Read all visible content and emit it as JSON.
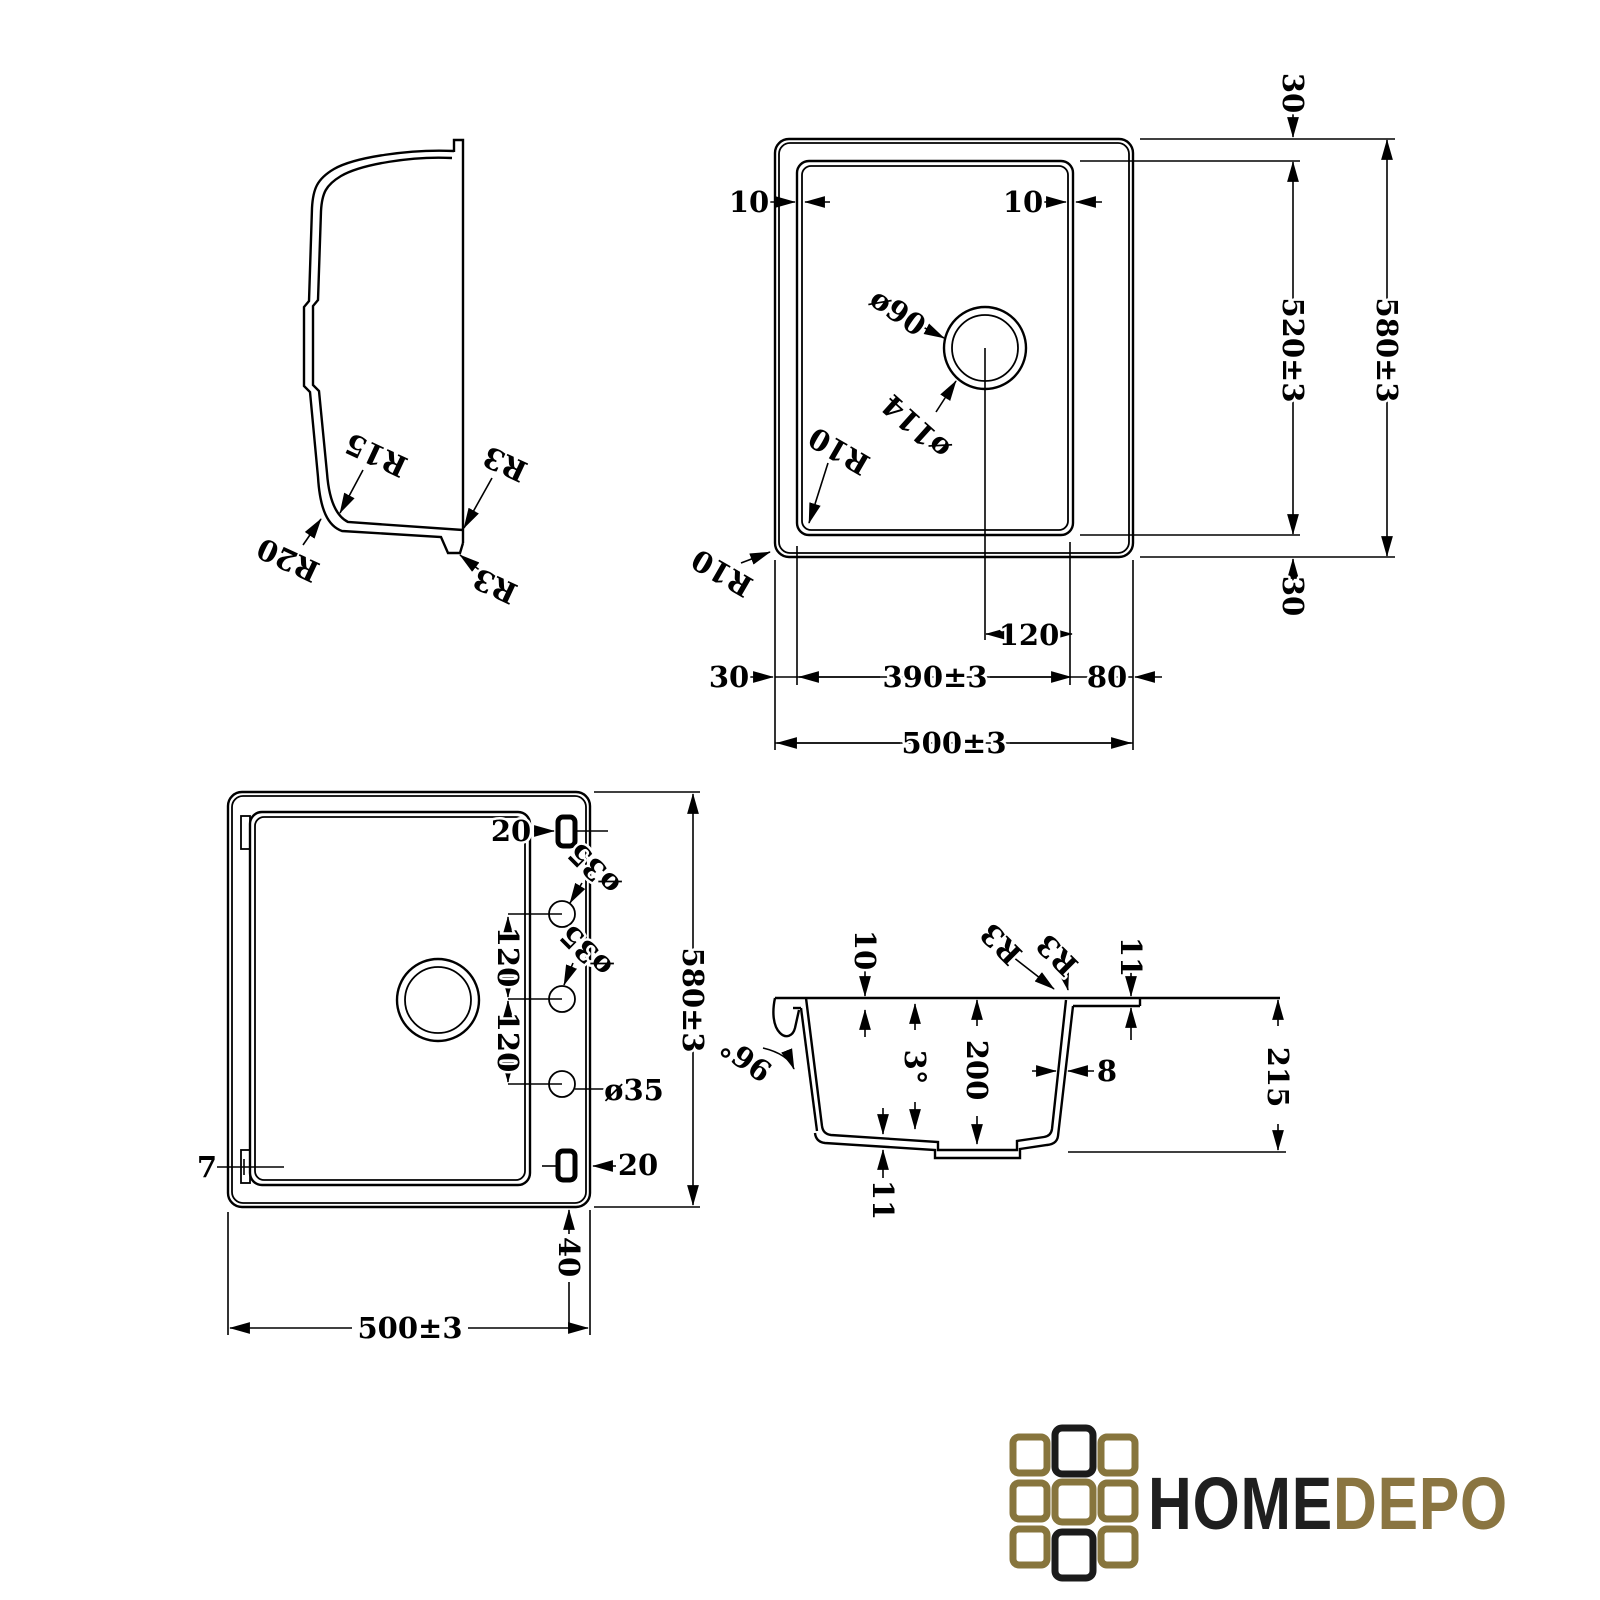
{
  "views": {
    "profile": {
      "r15": "R15",
      "r20": "R20",
      "r3_upper": "R3",
      "r3_lower": "R3"
    },
    "top": {
      "dim_30_top": "30",
      "dim_580": "580±3",
      "dim_520": "520±3",
      "dim_30_bottom": "30",
      "dim_10_left": "10",
      "dim_10_right": "10",
      "dia_90": "ø90",
      "dia_114": "ø114",
      "r10_inner": "R10",
      "r10_outer": "R10",
      "dim_120": "120",
      "dim_30_left": "30",
      "dim_390": "390±3",
      "dim_80": "80",
      "dim_500": "500±3"
    },
    "bottom": {
      "dim_20_top": "20",
      "dia_35_a": "ø35",
      "dia_35_b": "ø35",
      "dia_35_c": "ø35",
      "dim_120_a": "120",
      "dim_120_b": "120",
      "dim_580": "580±3",
      "dim_7": "7",
      "dim_20_bottom": "20",
      "dim_40": "40",
      "dim_500": "500±3"
    },
    "section": {
      "dim_10": "10",
      "r3_a": "R3",
      "r3_b": "R3",
      "dim_11_top": "11",
      "angle_96": "96°",
      "angle_3": "3°",
      "dim_200": "200",
      "dim_8": "8",
      "dim_11_bottom": "11",
      "dim_215": "215"
    }
  },
  "logo": {
    "home": "HOME",
    "depo": "DEPO",
    "gold": "#8a7541",
    "black": "#1f1f1f"
  }
}
